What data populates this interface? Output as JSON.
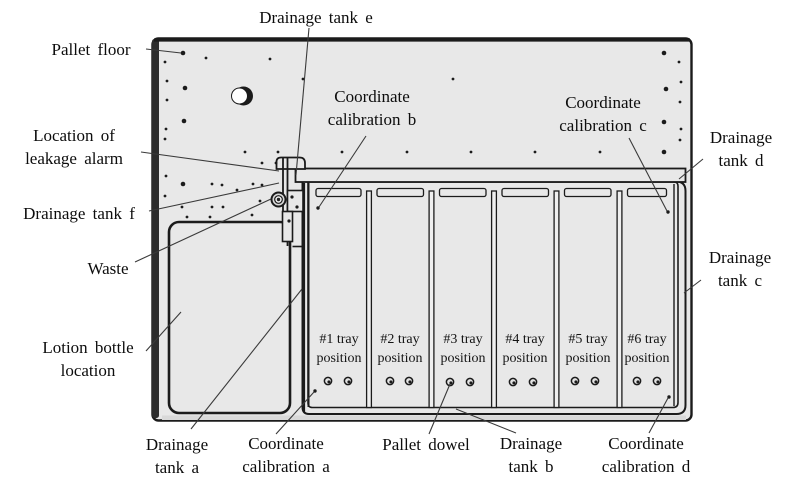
{
  "figure_title": "Pallet floor layout diagram",
  "labels": {
    "pallet_floor": {
      "text": "Pallet floor"
    },
    "drainage_tank_e": {
      "text": "Drainage tank e"
    },
    "location_of_leakage_alarm": {
      "line1": "Location of",
      "line2": "leakage alarm"
    },
    "drainage_tank_f": {
      "text": "Drainage tank f"
    },
    "waste": {
      "text": "Waste"
    },
    "lotion_bottle_location": {
      "line1": "Lotion bottle",
      "line2": "location"
    },
    "coordinate_calibration_b": {
      "line1": "Coordinate",
      "line2": "calibration b"
    },
    "coordinate_calibration_c": {
      "line1": "Coordinate",
      "line2": "calibration c"
    },
    "drainage_tank_d": {
      "line1": "Drainage",
      "line2": "tank d"
    },
    "drainage_tank_c": {
      "line1": "Drainage",
      "line2": "tank c"
    },
    "drainage_tank_a": {
      "line1": "Drainage",
      "line2": "tank a"
    },
    "coordinate_calibration_a": {
      "line1": "Coordinate",
      "line2": "calibration a"
    },
    "pallet_dowel": {
      "text": "Pallet dowel"
    },
    "drainage_tank_b": {
      "line1": "Drainage",
      "line2": "tank b"
    },
    "coordinate_calibration_d": {
      "line1": "Coordinate",
      "line2": "calibration d"
    }
  },
  "trays": [
    {
      "line1": "#1 tray",
      "line2": "position"
    },
    {
      "line1": "#2 tray",
      "line2": "position"
    },
    {
      "line1": "#3 tray",
      "line2": "position"
    },
    {
      "line1": "#4 tray",
      "line2": "position"
    },
    {
      "line1": "#5 tray",
      "line2": "position"
    },
    {
      "line1": "#6 tray",
      "line2": "position"
    }
  ],
  "diagram": {
    "colors": {
      "plate_fill": "#e8e8e8",
      "outline": "#1b1b1b",
      "edge_dark": "#2d2d2d",
      "leader": "#3a3a3a",
      "dot": "#1b1b1b"
    },
    "floor_dots": [
      [
        183,
        53,
        2.3
      ],
      [
        206,
        58,
        1.4
      ],
      [
        165,
        62,
        1.4
      ],
      [
        270,
        59,
        1.4
      ],
      [
        167,
        81,
        1.4
      ],
      [
        185,
        88,
        2.3
      ],
      [
        167,
        100,
        1.4
      ],
      [
        184,
        121,
        2.3
      ],
      [
        166,
        129,
        1.4
      ],
      [
        165,
        139,
        1.4
      ],
      [
        303,
        79,
        1.4
      ],
      [
        453,
        79,
        1.4
      ],
      [
        245,
        152,
        1.4
      ],
      [
        278,
        152,
        1.4
      ],
      [
        342,
        152,
        1.4
      ],
      [
        407,
        152,
        1.4
      ],
      [
        471,
        152,
        1.4
      ],
      [
        535,
        152,
        1.4
      ],
      [
        600,
        152,
        1.4
      ],
      [
        664,
        53,
        2.3
      ],
      [
        679,
        62,
        1.4
      ],
      [
        681,
        82,
        1.4
      ],
      [
        666,
        89,
        2.3
      ],
      [
        680,
        102,
        1.4
      ],
      [
        664,
        122,
        2.3
      ],
      [
        681,
        129,
        1.4
      ],
      [
        680,
        140,
        1.4
      ],
      [
        664,
        152,
        2.3
      ],
      [
        166,
        176,
        1.4
      ],
      [
        183,
        184,
        2.3
      ],
      [
        212,
        184,
        1.4
      ],
      [
        222,
        185,
        1.4
      ],
      [
        253,
        184,
        1.4
      ],
      [
        262,
        185,
        1.4
      ],
      [
        262,
        163,
        1.4
      ],
      [
        276,
        163,
        1.4
      ],
      [
        165,
        196,
        1.4
      ],
      [
        182,
        207,
        1.4
      ],
      [
        187,
        217,
        1.4
      ],
      [
        212,
        207,
        1.4
      ],
      [
        223,
        207,
        1.4
      ],
      [
        210,
        217,
        1.4
      ],
      [
        237,
        190,
        1.4
      ],
      [
        252,
        215,
        1.4
      ],
      [
        260,
        201,
        1.4
      ],
      [
        292,
        197,
        1.6
      ],
      [
        297,
        207,
        1.6
      ],
      [
        289,
        221,
        1.6
      ]
    ],
    "dowels": [
      [
        328,
        381
      ],
      [
        348,
        381
      ],
      [
        390,
        381
      ],
      [
        409,
        381
      ],
      [
        450,
        382
      ],
      [
        470,
        382
      ],
      [
        513,
        382
      ],
      [
        533,
        382
      ],
      [
        575,
        381
      ],
      [
        595,
        381
      ],
      [
        637,
        381
      ],
      [
        657,
        381
      ]
    ],
    "calibration_points": {
      "a": [
        315,
        391
      ],
      "b": [
        318,
        208
      ],
      "c": [
        668,
        212
      ],
      "d": [
        669,
        397
      ]
    },
    "hole_center": [
      240,
      96
    ],
    "leader_lines": [
      [
        146,
        49,
        181,
        53
      ],
      [
        309,
        28,
        296,
        175
      ],
      [
        141,
        152,
        279,
        171
      ],
      [
        149,
        211,
        279,
        183
      ],
      [
        135,
        262,
        271,
        199
      ],
      [
        146,
        351,
        181,
        312
      ],
      [
        191,
        429,
        302,
        289
      ],
      [
        276,
        434,
        314,
        392
      ],
      [
        429,
        434,
        450,
        384
      ],
      [
        516,
        433,
        456,
        409
      ],
      [
        649,
        433,
        668,
        398
      ],
      [
        629,
        138,
        667,
        211
      ],
      [
        703,
        159,
        679,
        179
      ],
      [
        701,
        280,
        684,
        293
      ],
      [
        366,
        136,
        319,
        207
      ]
    ]
  }
}
